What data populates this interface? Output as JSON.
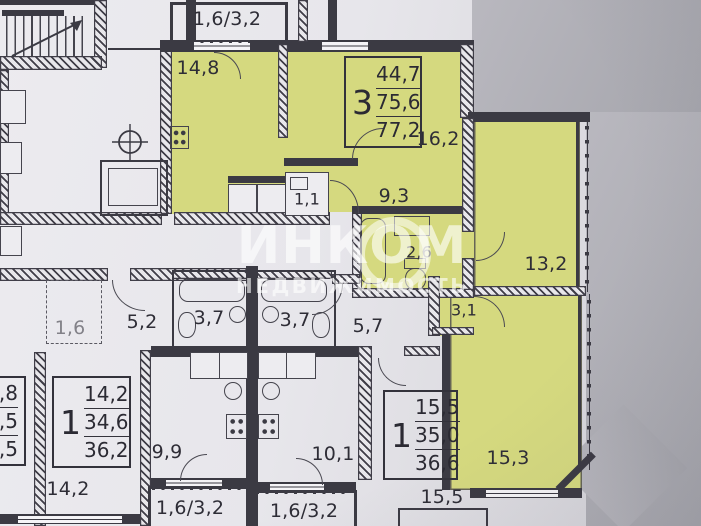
{
  "watermark": {
    "brand": "ИНКОМ",
    "subtitle": "НЕДВИЖИМОСТЬ"
  },
  "stamps": {
    "apt_3room": {
      "rooms": "3",
      "area_living": "44,7",
      "area_usable": "75,6",
      "area_total": "77,2"
    },
    "apt_1room_left": {
      "rooms": "1",
      "area_living": "14,2",
      "area_usable": "34,6",
      "area_total": "36,2"
    },
    "apt_1room_right": {
      "rooms": "1",
      "area_living": "15,5",
      "area_usable": "35,0",
      "area_total": "36,6"
    },
    "apt_edge_partial": {
      "area_living": ",8",
      "area_usable": ",5",
      "area_total": ",5"
    }
  },
  "rooms": {
    "balcony_top": "1,6/3,2",
    "kitchen_main": "14,8",
    "living_main": "16,2",
    "hall_main": "9,3",
    "wc_main": "1,1",
    "bath_main": "2,6",
    "bedroom_right": "13,2",
    "hall_inner": "3,1",
    "bedroom_lower": "15,3",
    "storage_left": "1,6",
    "hall_left": "5,2",
    "bath_left": "3,7",
    "bath_mid": "3,7",
    "hall_mid": "5,7",
    "kitchen_left": "9,9",
    "kitchen_mid": "10,1",
    "room_bottom_left": "14,2",
    "room_bottom_right": "15,5",
    "balcony_bottom_left": "1,6/3,2",
    "balcony_bottom_mid": "1,6/3,2"
  },
  "colors": {
    "highlight": "#d5d97f",
    "wall": "#3b3a43",
    "paper": "#e9e8ec",
    "shadow_gray": "#a7a7ad"
  }
}
